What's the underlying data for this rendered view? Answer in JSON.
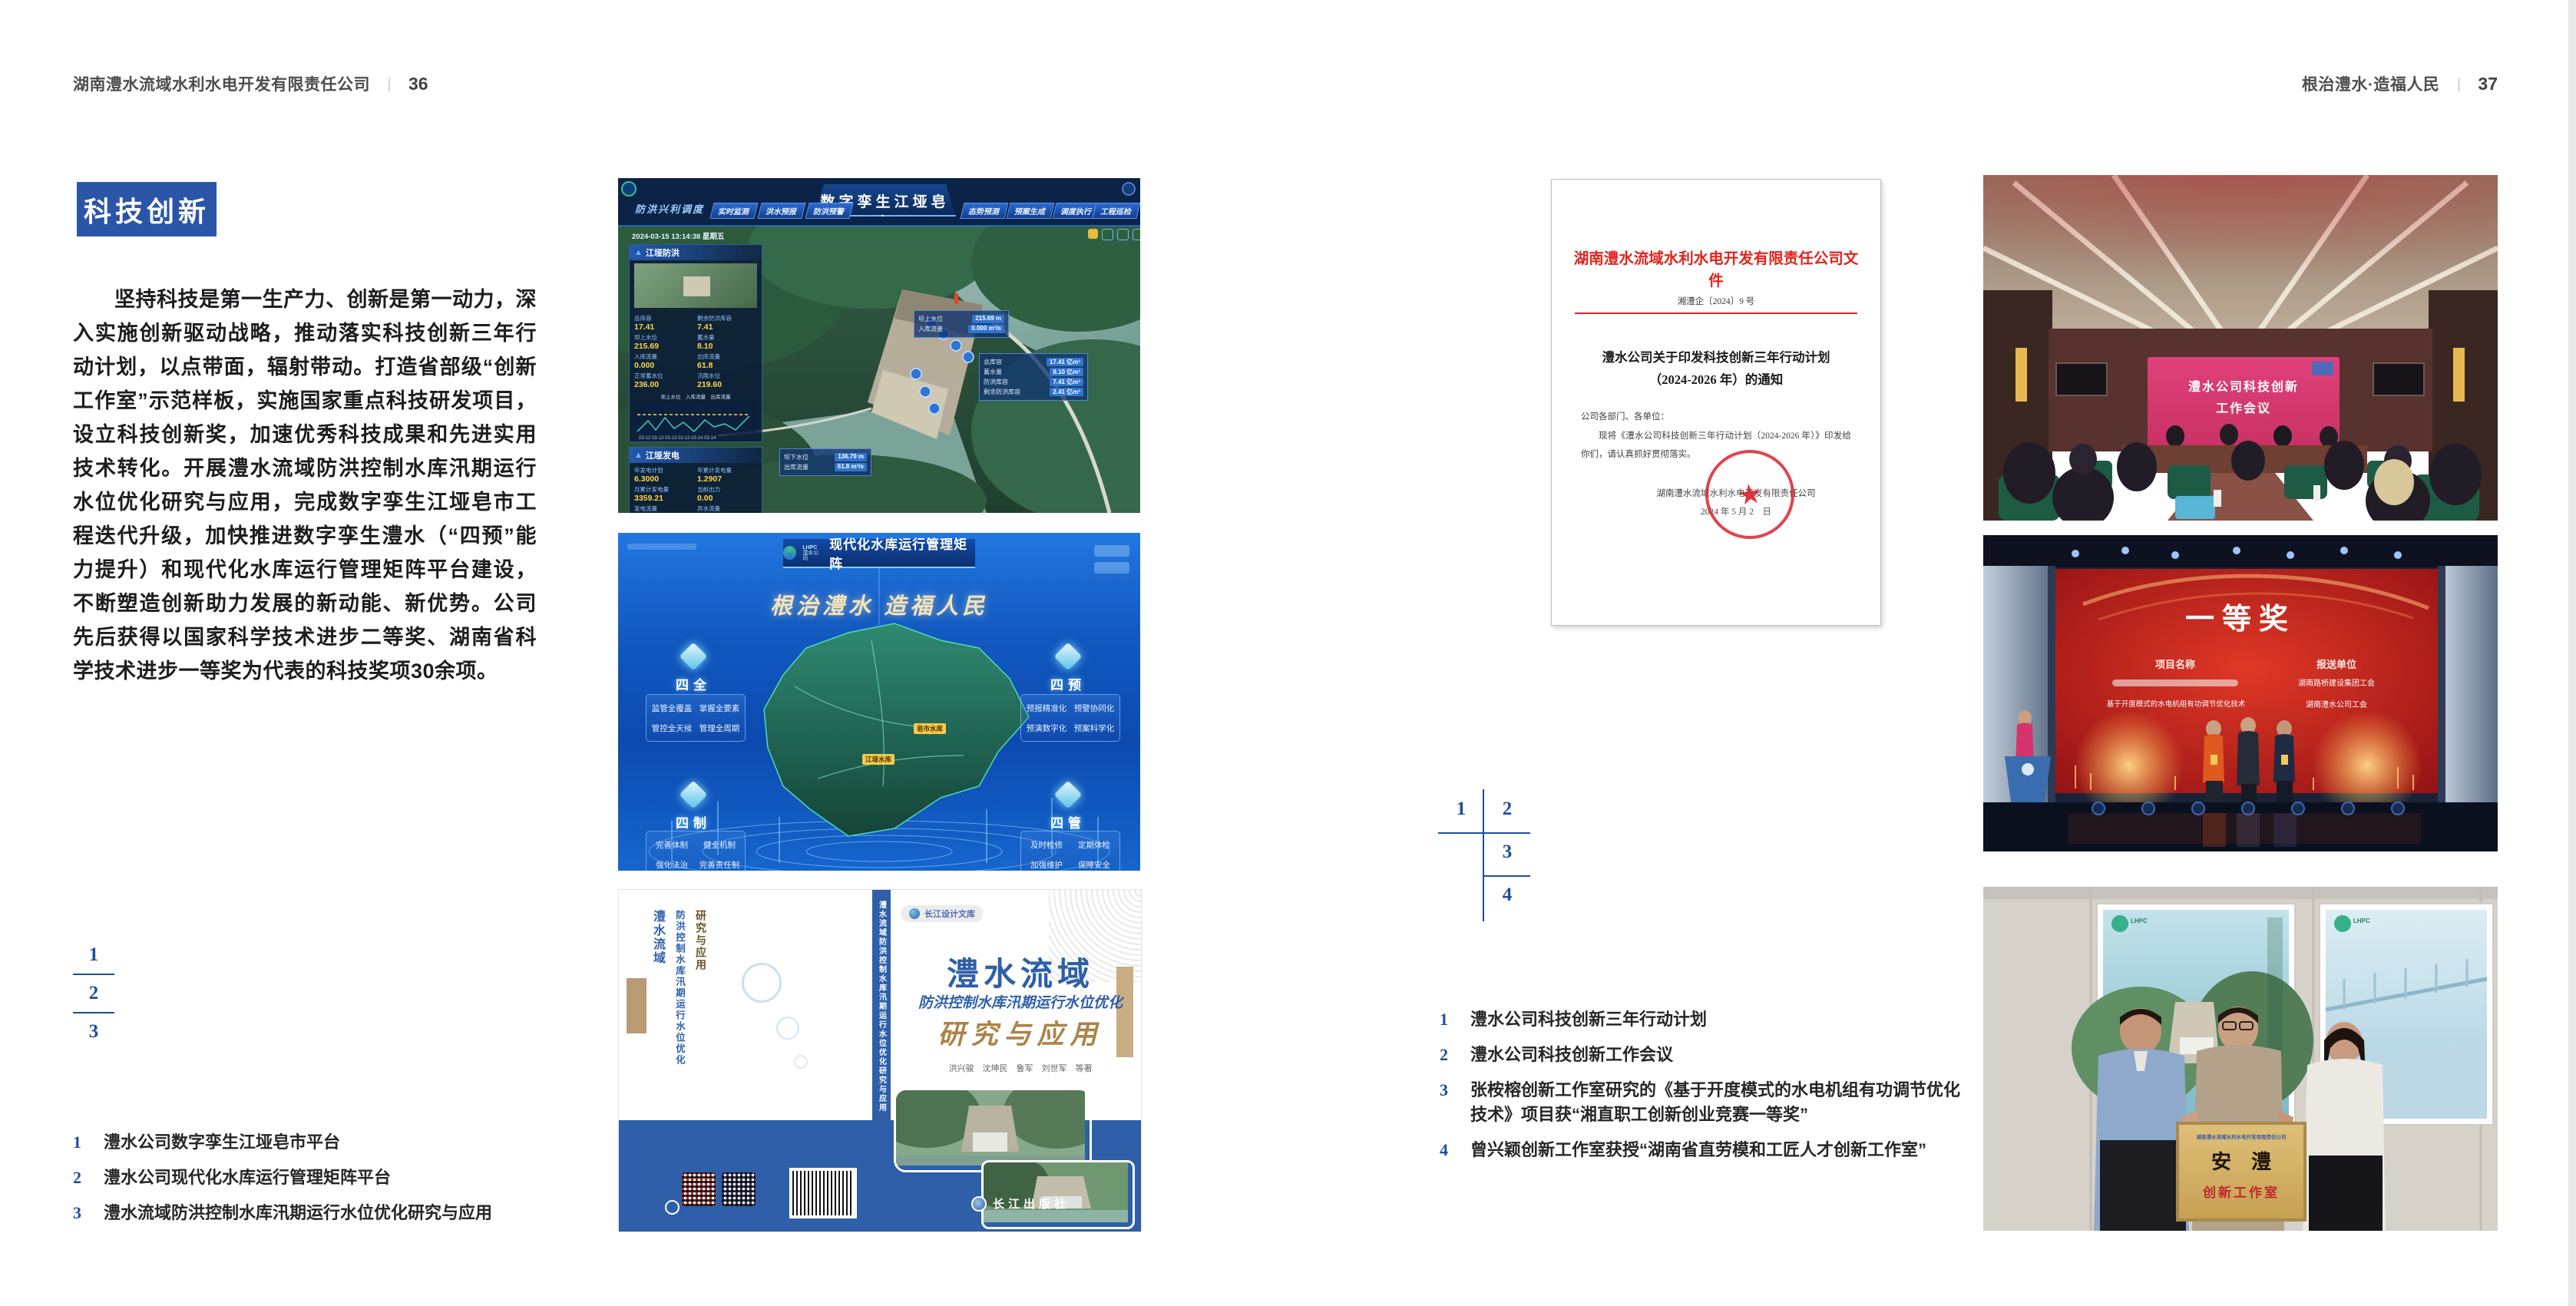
{
  "colors": {
    "accent_blue": "#2b55a7",
    "index_blue": "#1d4e9e",
    "doc_red": "#d9232e"
  },
  "left": {
    "header_title": "湖南澧水流域水利水电开发有限责任公司",
    "header_divider": "｜",
    "header_page": "36",
    "section_title": "科技创新",
    "body": "坚持科技是第一生产力、创新是第一动力，深入实施创新驱动战略，推动落实科技创新三年行动计划，以点带面，辐射带动。打造省部级“创新工作室”示范样板，实施国家重点科技研发项目，设立科技创新奖，加速优秀科技成果和先进实用技术转化。开展澧水流域防洪控制水库汛期运行水位优化研究与应用，完成数字孪生江垭皂市工程迭代升级，加快推进数字孪生澧水（“四预”能力提升）和现代化水库运行管理矩阵平台建设，不断塑造创新助力发展的新动能、新优势。公司先后获得以国家科学技术进步二等奖、湖南省科学技术进步一等奖为代表的科技奖项30余项。",
    "index_nums": [
      "1",
      "2",
      "3"
    ],
    "captions": [
      {
        "num": "1",
        "text": "澧水公司数字孪生江垭皂市平台"
      },
      {
        "num": "2",
        "text": "澧水公司现代化水库运行管理矩阵平台"
      },
      {
        "num": "3",
        "text": "澧水流域防洪控制水库汛期运行水位优化研究与应用"
      }
    ]
  },
  "right": {
    "header_title": "根治澧水·造福人民",
    "header_divider": "｜",
    "header_page": "37",
    "index_nums": [
      "1",
      "2",
      "3",
      "4"
    ],
    "captions": [
      {
        "num": "1",
        "text": "澧水公司科技创新三年行动计划"
      },
      {
        "num": "2",
        "text": "澧水公司科技创新工作会议"
      },
      {
        "num": "3",
        "text": "张桉榕创新工作室研究的《基于开度模式的水电机组有功调节优化技术》项目获“湘直职工创新创业竞赛一等奖”"
      },
      {
        "num": "4",
        "text": "曾兴颖创新工作室获授“湖南省直劳模和工匠人才创新工作室”"
      }
    ]
  },
  "dt": {
    "title": "数字孪生江垭皂市",
    "module": "防洪兴利调度",
    "tabs_left": [
      "实时监测",
      "洪水预报",
      "防洪预警"
    ],
    "tabs_right": [
      "态势预测",
      "预案生成",
      "调度执行",
      "工程巡检"
    ],
    "datetime": "2024-03-15 13:14:38 星期五",
    "flood_title": "江垭防洪",
    "flood_stats": [
      {
        "l": "总库容",
        "v": "17.41"
      },
      {
        "l": "剩余防洪库容",
        "v": "7.41"
      },
      {
        "l": "坝上水位",
        "v": "215.69"
      },
      {
        "l": "蓄水量",
        "v": "8.10"
      },
      {
        "l": "入库流量",
        "v": "0.000"
      },
      {
        "l": "出库流量",
        "v": "61.8"
      },
      {
        "l": "正常蓄水位",
        "v": "236.00"
      },
      {
        "l": "汛限水位",
        "v": "219.60"
      }
    ],
    "legend": "坝上水位　入库流量　出库流量",
    "chart_x": "03-12  03-13  03-13  03-13  03-14  03-14",
    "power_title": "江垭发电",
    "power_stats": [
      {
        "l": "年发电计划",
        "v": "6.3000"
      },
      {
        "l": "年累计发电量",
        "v": "1.2907"
      },
      {
        "l": "月累计发电量",
        "v": "3359.21"
      },
      {
        "l": "当前出力",
        "v": "0.00"
      },
      {
        "l": "发电流量",
        "v": "0.00"
      },
      {
        "l": "弃水流量",
        "v": "0.00"
      }
    ],
    "tip1": [
      {
        "l": "坝上水位",
        "v": "215.69 m"
      },
      {
        "l": "入库流量",
        "v": "0.000 m³/s"
      }
    ],
    "tip2": [
      {
        "l": "总库容",
        "v": "17.41 亿m³"
      },
      {
        "l": "蓄水量",
        "v": "8.10 亿m³"
      },
      {
        "l": "防洪库容",
        "v": "7.41 亿m³"
      },
      {
        "l": "剩余防洪库容",
        "v": "2.41 亿m³"
      }
    ],
    "tip3": [
      {
        "l": "坝下水位",
        "v": "136.79 m"
      },
      {
        "l": "出库流量",
        "v": "61.8 m³/s"
      }
    ]
  },
  "mx": {
    "logo": "LHPC",
    "logo_sub": "澧水公司",
    "title": "现代化水库运行管理矩阵",
    "slogan": "根治澧水  造福人民",
    "groups": [
      {
        "name": "四全",
        "items": [
          "监管全覆盖",
          "掌握全要素",
          "管控全天候",
          "管理全周期"
        ]
      },
      {
        "name": "四预",
        "items": [
          "预报精准化",
          "预警协同化",
          "预演数字化",
          "预案科学化"
        ]
      },
      {
        "name": "四制",
        "items": [
          "完善体制",
          "健全机制",
          "强化法治",
          "完善责任制"
        ]
      },
      {
        "name": "四管",
        "items": [
          "及时检修",
          "定期体检",
          "加强维护",
          "保障安全"
        ]
      }
    ],
    "markers": [
      "皂市水库",
      "江垭水库"
    ]
  },
  "bk": {
    "series": "长江设计文库",
    "t1": "澧水流域",
    "t2": "防洪控制水库汛期运行水位优化",
    "t3": "研究与应用",
    "authors": "洪兴骏　沈坤民　鲁军　刘世军　等著",
    "spine": "澧水流域防洪控制水库汛期运行水位优化研究与应用",
    "publisher": "长江出版社"
  },
  "doc": {
    "header": "湖南澧水流域水利水电开发有限责任公司文件",
    "no": "湘澧企〔2024〕9 号",
    "t1": "澧水公司关于印发科技创新三年行动计划",
    "t2": "（2024-2026 年）的通知",
    "salutation": "公司各部门、各单位：",
    "body": "现将《澧水公司科技创新三年行动计划（2024-2026 年）》印发给你们，请认真抓好贯彻落实。",
    "signer": "湖南澧水流域水利水电开发有限责任公司",
    "date": "2024 年 5 月 2　日",
    "seal_star": "★"
  },
  "mt": {
    "s1": "澧水公司科技创新",
    "s2": "工作会议"
  },
  "aw": {
    "grade": "一等奖",
    "c1": "项目名称",
    "c2": "报送单位",
    "p2": "基于开度模式的水电机组有功调节优化技术",
    "o1": "湖南路桥建设集团工会",
    "o2": "湖南澧水公司工会"
  },
  "pq": {
    "company": "湖南澧水流域水利水电开发有限责任公司",
    "name": "安　澧",
    "sub": "创新工作室",
    "logo": "LHPC"
  }
}
